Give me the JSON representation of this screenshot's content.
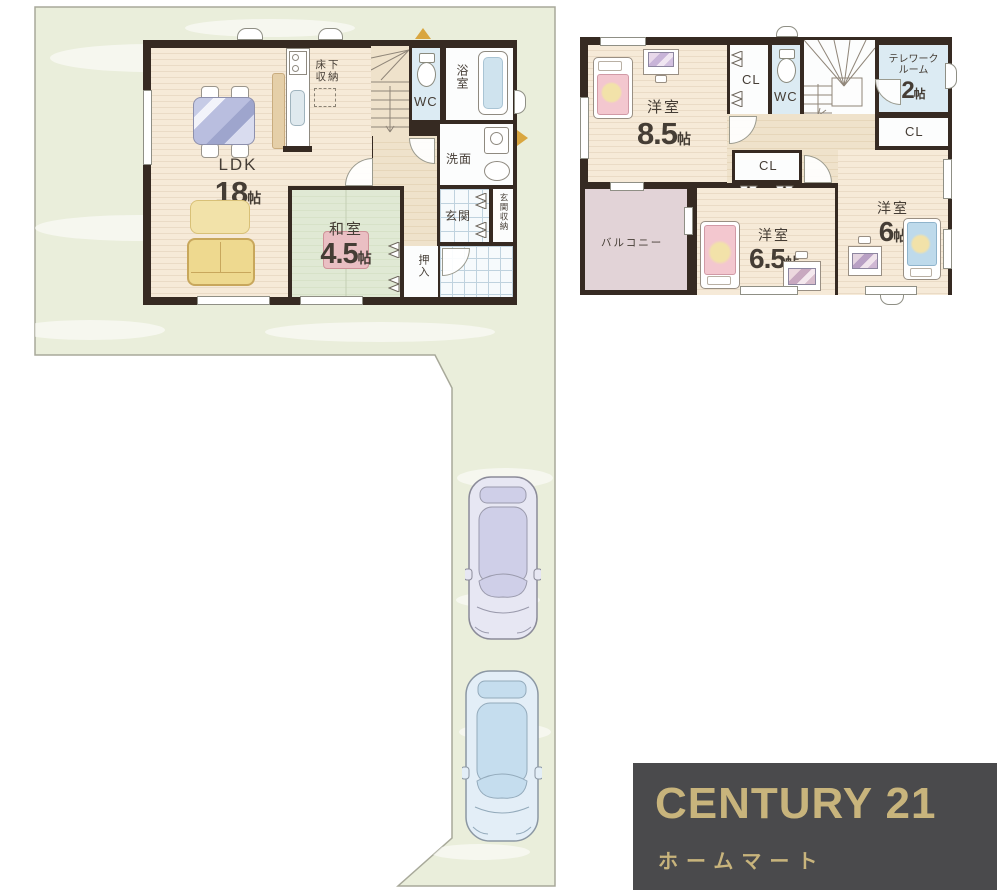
{
  "colors": {
    "wall": "#362a22",
    "wood": "#f6ead8",
    "wood_line": "#eadbc6",
    "tatami": "#e0e9d4",
    "tatami_line": "#c3d0b5",
    "hall": "#efe2cb",
    "aqua": "#dcebf3",
    "porch_line": "#bfd2de",
    "balcony": "#e2d3d7",
    "land": "#eaeedb",
    "land_border": "#a8a99a",
    "pink_bed": "#f3c7cf",
    "blue_bed": "#bedaeb",
    "blanket_yellow": "#f2e2a9",
    "sofa": "#eed98f",
    "sofa_line": "#c8a75c",
    "table_blue": "#b9bedf",
    "tatami_table": "#eabfc3",
    "tan": "#d9a640",
    "gold": "#c8b47c",
    "logo_bg": "#4a4a4c",
    "car1": "#e7e7f3",
    "car1_glass": "#cfcfe8",
    "car2": "#e3eef7",
    "car2_glass": "#c5ddee"
  },
  "floor1": {
    "ldk": {
      "name": "LDK",
      "size": "18",
      "unit": "帖"
    },
    "washitsu": {
      "name": "和室",
      "size": "4.5",
      "unit": "帖"
    },
    "yukashita_line1": "床下",
    "yukashita_line2": "収納",
    "wc": "WC",
    "bath": "浴室",
    "senmen": "洗面",
    "genkan": "玄関",
    "genkan_shuno": "玄関収納",
    "oshiire": "押入"
  },
  "floor2": {
    "room85": {
      "name": "洋室",
      "size": "8.5",
      "unit": "帖"
    },
    "room65": {
      "name": "洋室",
      "size": "6.5",
      "unit": "帖"
    },
    "room6": {
      "name": "洋室",
      "size": "6",
      "unit": "帖"
    },
    "telework": {
      "line1": "テレワーク",
      "line2": "ルーム",
      "size": "2",
      "unit": "帖"
    },
    "cl_a": "CL",
    "cl_b": "CL",
    "cl_c": "CL",
    "wc": "WC",
    "balcony": "バルコニー"
  },
  "logo": {
    "brand": "CENTURY 21",
    "shop": "ホームマート"
  }
}
